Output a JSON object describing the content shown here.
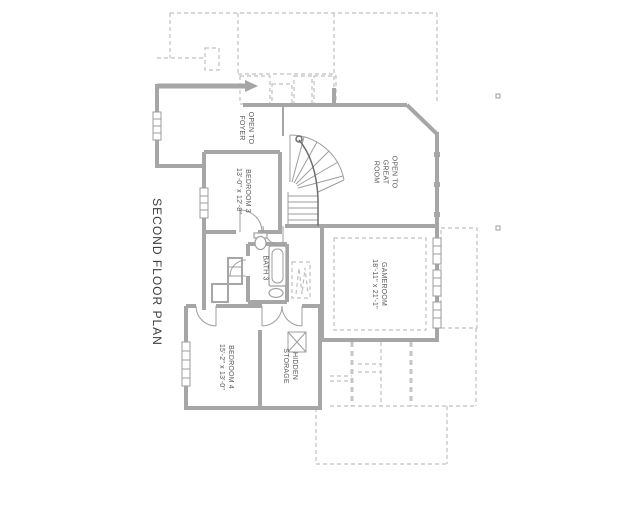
{
  "title": "SECOND FLOOR PLAN",
  "rooms": {
    "open_to_foyer": {
      "line1": "OPEN TO",
      "line2": "FOYER"
    },
    "bedroom3": {
      "name": "BEDROOM 3",
      "dims": "13'-0\" x 12'-8\""
    },
    "open_to_great_room": {
      "line1": "OPEN TO",
      "line2": "GREAT",
      "line3": "ROOM"
    },
    "gameroom": {
      "name": "GAMEROOM",
      "dims": "18'-11\" x 21'-1\""
    },
    "bath3": {
      "name": "BATH 3"
    },
    "bedroom4": {
      "name": "BEDROOM 4",
      "dims": "15'-2\" x 13'-0\""
    },
    "hidden_storage": {
      "line1": "HIDDEN",
      "line2": "STORAGE"
    }
  },
  "colors": {
    "background": "#ffffff",
    "wall": "#a6a6a6",
    "line": "#9d9d9d",
    "dashed": "#c0c0c0",
    "text": "#4a4a4a"
  }
}
